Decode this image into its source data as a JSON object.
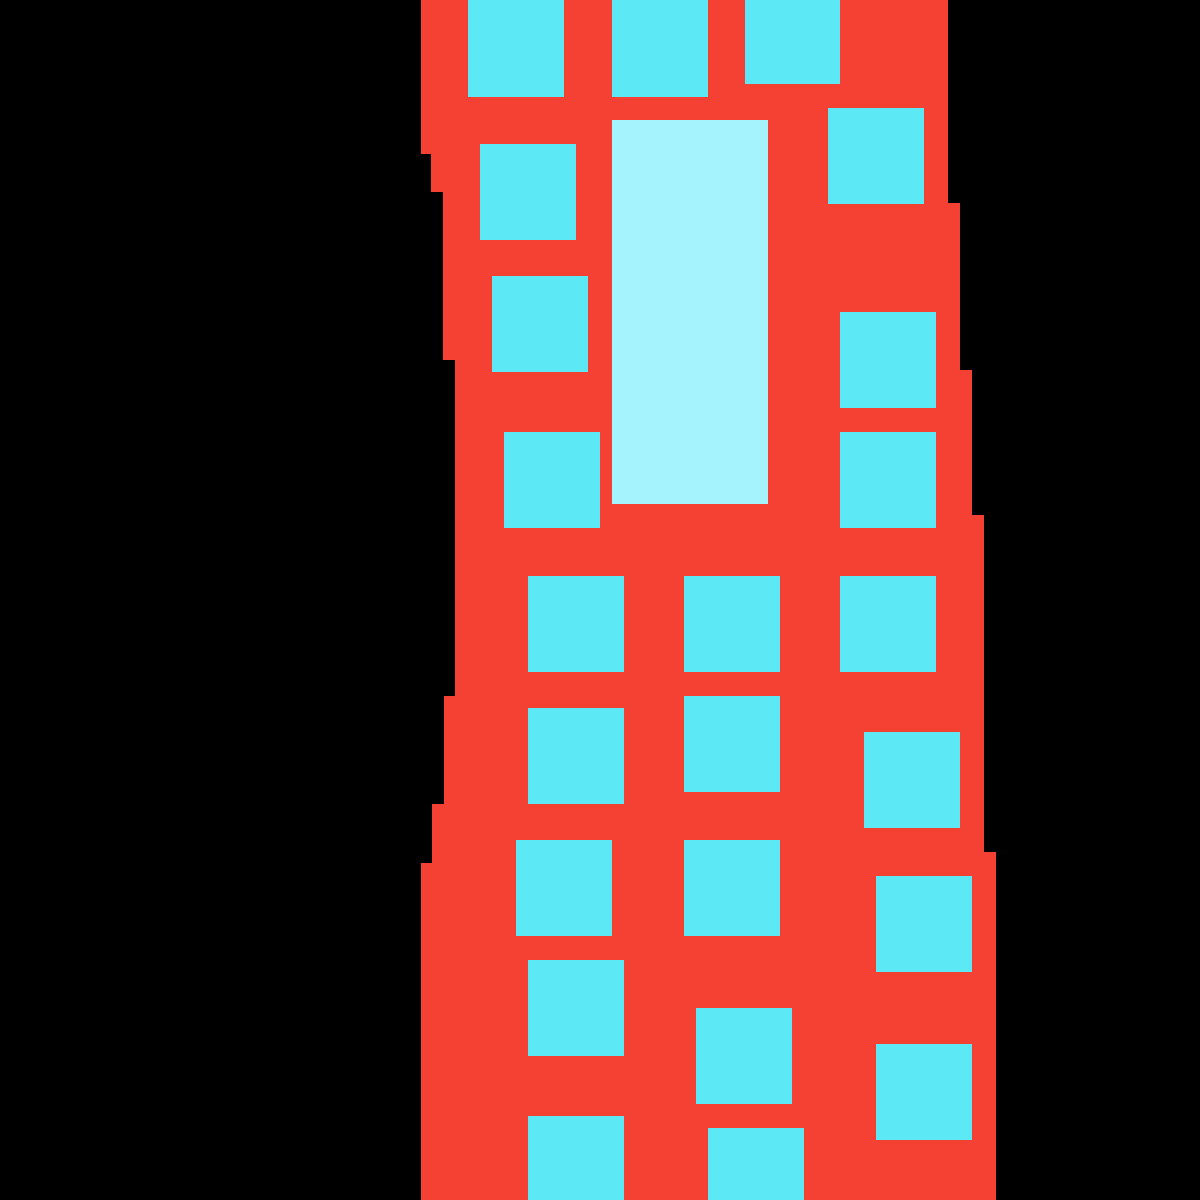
{
  "scene": {
    "description": "Pixel-art drawing of a tall red building with cyan square windows and one large pale-cyan vertical window, on a black background",
    "canvas": {
      "width": 1200,
      "height": 1200,
      "background_color": "#000000"
    },
    "building": {
      "fill_color": "#f44134",
      "outline_points": [
        [
          421,
          0
        ],
        [
          948,
          0
        ],
        [
          948,
          203
        ],
        [
          960,
          203
        ],
        [
          960,
          370
        ],
        [
          972,
          370
        ],
        [
          972,
          515
        ],
        [
          984,
          515
        ],
        [
          984,
          852
        ],
        [
          996,
          852
        ],
        [
          996,
          1200
        ],
        [
          421,
          1200
        ],
        [
          421,
          863
        ],
        [
          432,
          863
        ],
        [
          432,
          804
        ],
        [
          444,
          804
        ],
        [
          444,
          696
        ],
        [
          455,
          696
        ],
        [
          455,
          360
        ],
        [
          443,
          360
        ],
        [
          443,
          192
        ],
        [
          431,
          192
        ],
        [
          431,
          154
        ],
        [
          421,
          154
        ]
      ]
    },
    "door": {
      "x": 612,
      "y": 120,
      "width": 156,
      "height": 384,
      "fill_color": "#a5f3fd"
    },
    "windows": {
      "fill_color": "#5ce9f5",
      "count": 23,
      "rects": [
        [
          468,
          0,
          96,
          97
        ],
        [
          612,
          0,
          96,
          97
        ],
        [
          745,
          0,
          95,
          84
        ],
        [
          828,
          108,
          96,
          96
        ],
        [
          480,
          144,
          96,
          96
        ],
        [
          492,
          276,
          96,
          96
        ],
        [
          840,
          312,
          96,
          96
        ],
        [
          504,
          432,
          96,
          96
        ],
        [
          840,
          432,
          96,
          96
        ],
        [
          528,
          576,
          96,
          96
        ],
        [
          684,
          576,
          96,
          96
        ],
        [
          840,
          576,
          96,
          96
        ],
        [
          684,
          696,
          96,
          96
        ],
        [
          528,
          708,
          96,
          96
        ],
        [
          864,
          732,
          96,
          96
        ],
        [
          516,
          840,
          96,
          96
        ],
        [
          684,
          840,
          96,
          96
        ],
        [
          876,
          876,
          96,
          96
        ],
        [
          528,
          960,
          96,
          96
        ],
        [
          696,
          1008,
          96,
          96
        ],
        [
          876,
          1044,
          96,
          96
        ],
        [
          528,
          1116,
          96,
          84
        ],
        [
          708,
          1128,
          96,
          72
        ]
      ]
    }
  }
}
